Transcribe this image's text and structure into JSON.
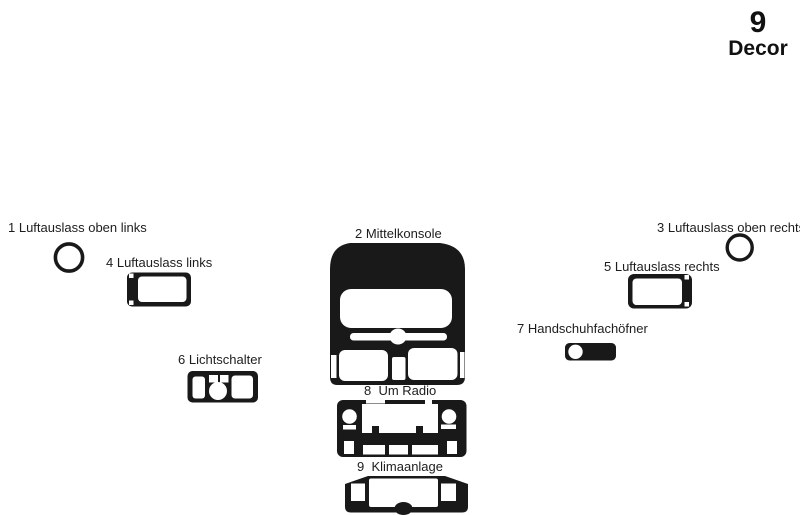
{
  "header": {
    "series_number": "9",
    "series_label": "Decor"
  },
  "colors": {
    "ink": "#191919",
    "background": "#ffffff"
  },
  "parts": [
    {
      "label": "1 Luftauslass oben links"
    },
    {
      "label": "2 Mittelkonsole"
    },
    {
      "label": "3 Luftauslass oben rechts"
    },
    {
      "label": "4 Luftauslass links"
    },
    {
      "label": "5 Luftauslass rechts"
    },
    {
      "label": "6 Lichtschalter"
    },
    {
      "label": "7 Handschuhfachöfner"
    },
    {
      "label": "8  Um Radio"
    },
    {
      "label": "9  Klimaanlage"
    }
  ]
}
